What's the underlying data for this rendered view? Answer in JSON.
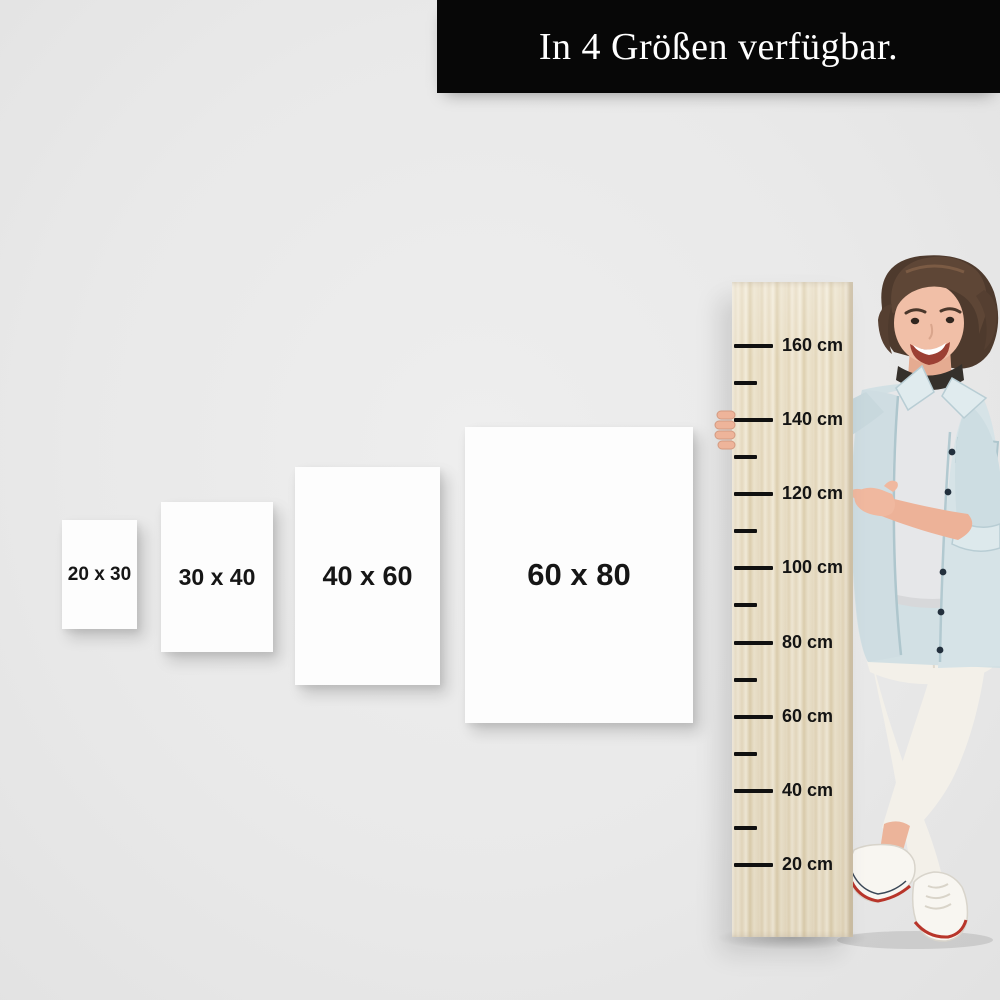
{
  "banner": {
    "text": "In 4 Größen verfügbar."
  },
  "size_cards": [
    {
      "label": "20 x 30"
    },
    {
      "label": "30 x 40"
    },
    {
      "label": "40 x 60"
    },
    {
      "label": "60 x 80"
    }
  ],
  "ruler": {
    "unit": "cm",
    "max_cm": 160,
    "min_cm": 20,
    "ticks": [
      {
        "cm": 160,
        "label": "160 cm"
      },
      {
        "cm": 150
      },
      {
        "cm": 140,
        "label": "140 cm"
      },
      {
        "cm": 130
      },
      {
        "cm": 120,
        "label": "120 cm"
      },
      {
        "cm": 110
      },
      {
        "cm": 100,
        "label": "100 cm"
      },
      {
        "cm": 90
      },
      {
        "cm": 80,
        "label": "80 cm"
      },
      {
        "cm": 70
      },
      {
        "cm": 60,
        "label": "60 cm"
      },
      {
        "cm": 50
      },
      {
        "cm": 40,
        "label": "40 cm"
      },
      {
        "cm": 30
      },
      {
        "cm": 20,
        "label": "20 cm"
      }
    ]
  },
  "figure": {
    "alt": "Smiling woman with short brown hair, light denim jacket and white pants, pointing at a wooden height ruler"
  },
  "colors": {
    "background": "#e9e9e9",
    "banner_bg": "#070707",
    "banner_text": "#ffffff",
    "card_bg": "#fdfdfd",
    "card_text": "#161616",
    "ruler_wood": "#e8ddc6",
    "tick": "#101010",
    "denim_jacket": "#d2e0e4",
    "tshirt": "#e6e7e9",
    "pants": "#f3f0e9",
    "hair": "#5e4636",
    "skin": "#f0bda4",
    "shoe_stripe": "#b8352a"
  }
}
